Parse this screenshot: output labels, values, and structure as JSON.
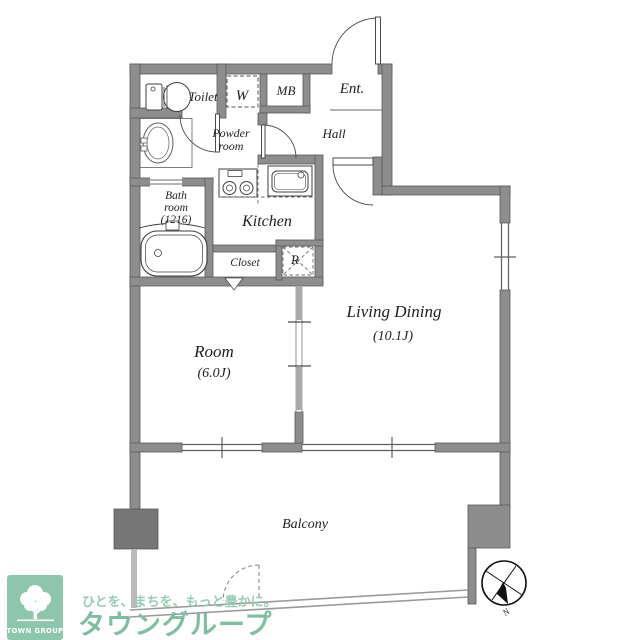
{
  "floorplan": {
    "rooms": {
      "toilet": "Toilet",
      "w_closet": "W",
      "mb": "MB",
      "entrance": "Ent.",
      "powder_line1": "Powder",
      "powder_line2": "room",
      "hall": "Hall",
      "bath_line1": "Bath",
      "bath_line2": "room",
      "bath_line3": "(1216)",
      "kitchen": "Kitchen",
      "closet": "Closet",
      "refrigerator": "R",
      "room": "Room",
      "room_size": "(6.0J)",
      "living_dining": "Living Dining",
      "living_dining_size": "(10.1J)",
      "balcony": "Balcony"
    },
    "compass": {
      "north": "N"
    },
    "colors": {
      "wall": "#8d8d8d",
      "wall_edge": "#5a5a5a",
      "pillar": "#767676",
      "line": "#3f3f3f",
      "brand_green": "#7ebfa1",
      "tagline_green": "#97cdb4",
      "logo_box_green": "#8cc6ab"
    }
  },
  "logo": {
    "box_label": "TOWN GROUP",
    "tagline": "ひとを、まちを、もっと豊かに。",
    "brand": "タウングループ"
  }
}
